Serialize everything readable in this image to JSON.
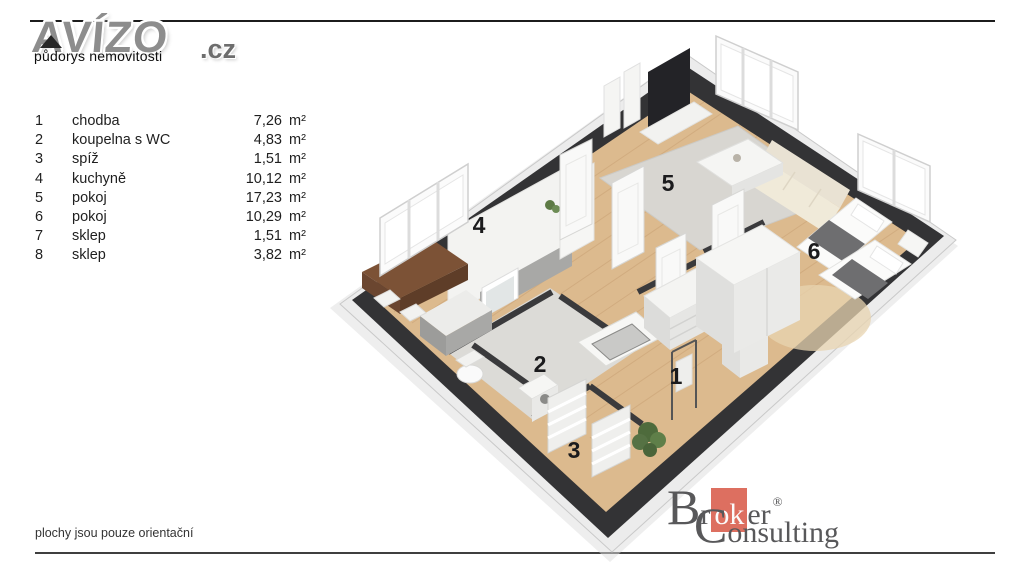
{
  "watermark": {
    "brand": "AVÍZO",
    "brand_suffix": ".cz",
    "subtitle": "půdorys nemovitosti"
  },
  "legend": {
    "rows": [
      {
        "num": "1",
        "name": "chodba",
        "area": "7,26",
        "unit": "m²"
      },
      {
        "num": "2",
        "name": "koupelna s WC",
        "area": "4,83",
        "unit": "m²"
      },
      {
        "num": "3",
        "name": "spíž",
        "area": "1,51",
        "unit": "m²"
      },
      {
        "num": "4",
        "name": "kuchyně",
        "area": "10,12",
        "unit": "m²"
      },
      {
        "num": "5",
        "name": "pokoj",
        "area": "17,23",
        "unit": "m²"
      },
      {
        "num": "6",
        "name": "pokoj",
        "area": "10,29",
        "unit": "m²"
      },
      {
        "num": "7",
        "name": "sklep",
        "area": "1,51",
        "unit": "m²"
      },
      {
        "num": "8",
        "name": "sklep",
        "area": "3,82",
        "unit": "m²"
      }
    ]
  },
  "floorplan": {
    "labels": [
      {
        "text": "1"
      },
      {
        "text": "2"
      },
      {
        "text": "3"
      },
      {
        "text": "4"
      },
      {
        "text": "5"
      },
      {
        "text": "6"
      }
    ]
  },
  "footer": {
    "note": "plochy jsou pouze orientační"
  },
  "broker_logo": {
    "b_cap": "B",
    "b_pre": "r",
    "b_highlight": "ok",
    "b_post": "er",
    "reg": "®",
    "c_cap": "C",
    "c_rest": "onsulting",
    "accent_color": "#dd6f60",
    "text_color": "#58585a"
  },
  "colors": {
    "wall": "#333335",
    "floor_wood": "#dcba8e",
    "bath_tile": "#dcdbd7",
    "rug": "#d8d6d1",
    "accent_red": "#dd6f60"
  }
}
